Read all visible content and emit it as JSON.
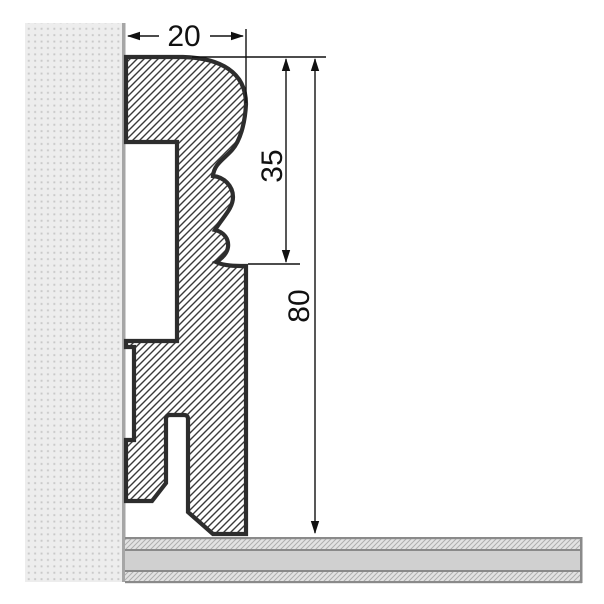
{
  "drawing": {
    "dimensions": {
      "width": "20",
      "upper_height": "35",
      "total_height": "80"
    },
    "colors": {
      "outline": "#2d2d2d",
      "hatch_line": "#3a3a3a",
      "wall_fill": "#ededed",
      "wall_dots": "#c8c8c8",
      "wall_edge": "#a6a6a6",
      "floor_band_hatch_bg": "#e3e3e3",
      "floor_hatch_line": "#aeaeae",
      "floor_band_solid": "#d0d0d0",
      "floor_border": "#8a8a8a",
      "dimension_color": "#111111",
      "profile_fill_bg": "#ffffff"
    }
  }
}
